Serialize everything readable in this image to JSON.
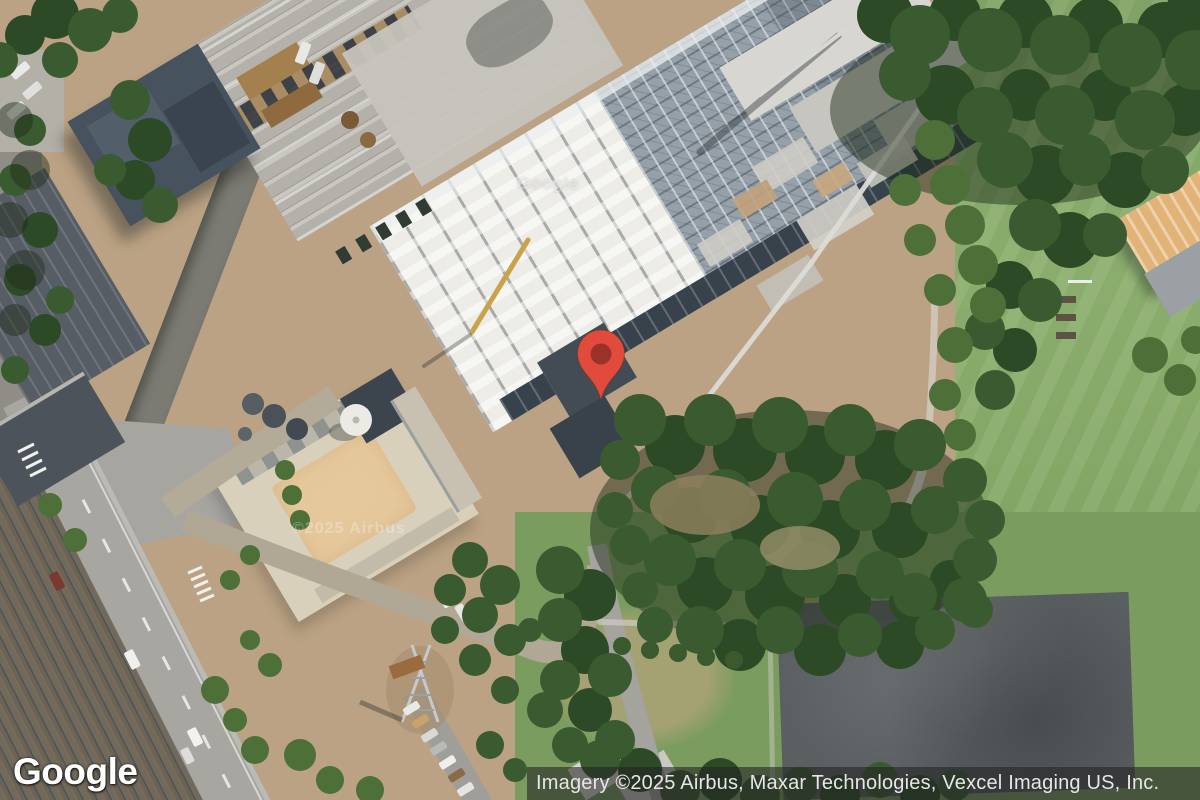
{
  "app": {
    "view": "satellite-map"
  },
  "branding": {
    "logo_text": "Google"
  },
  "attribution": {
    "text": "Imagery ©2025 Airbus, Maxar Technologies, Vexcel Imaging US, Inc.",
    "bar_color": "rgba(34,34,34,0.58)",
    "text_color": "#e6e6e6"
  },
  "tile_watermarks": {
    "google": "Google",
    "airbus": "©2025 Airbus"
  },
  "marker": {
    "name": "location-pin",
    "color": "#e14b3b",
    "inner_color": "#9a322a"
  }
}
